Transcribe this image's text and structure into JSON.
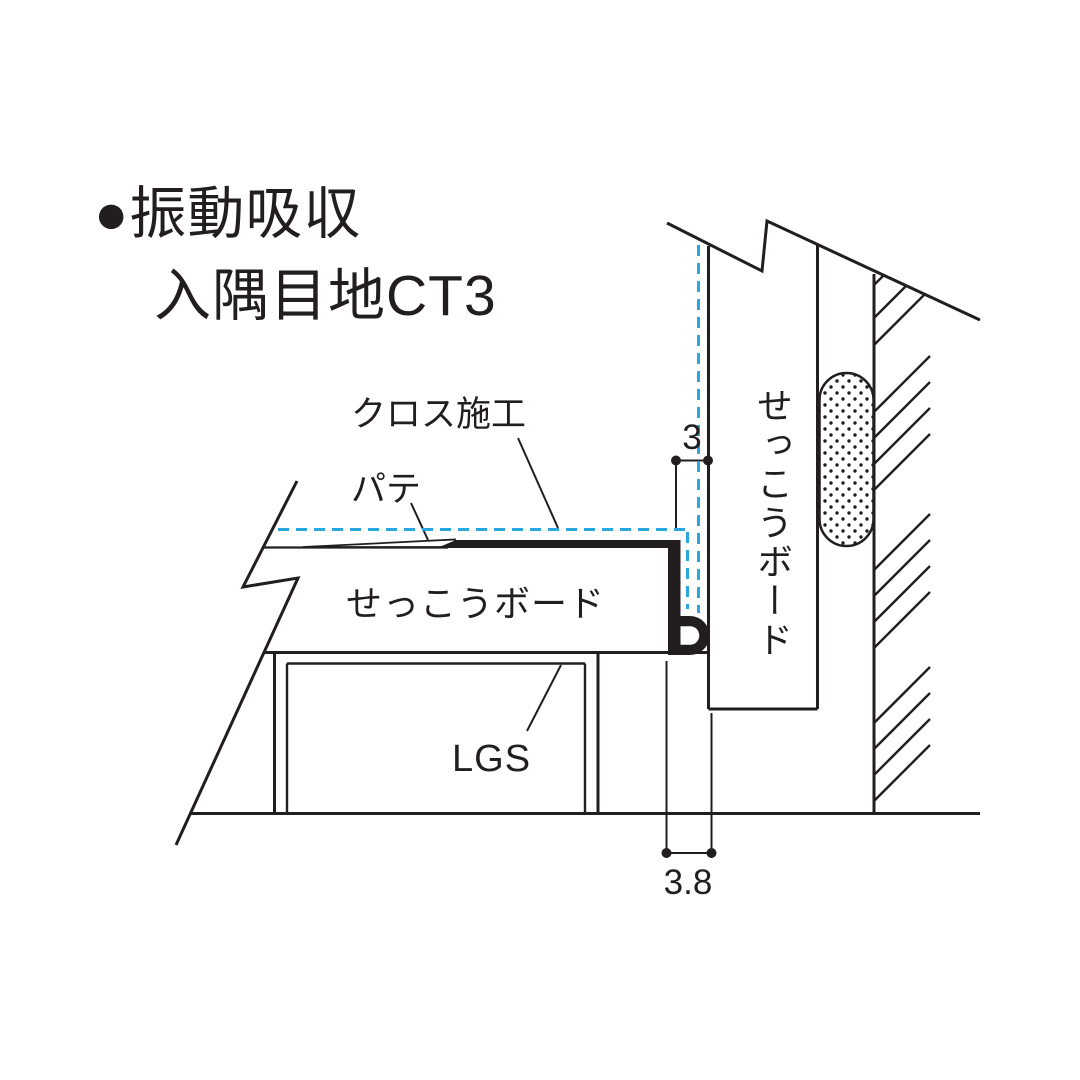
{
  "title": {
    "line1": "●振動吸収",
    "line2": "入隅目地CT3"
  },
  "labels": {
    "cross_finish": "クロス施工",
    "putty": "パテ",
    "gypsum_board_ceiling": "せっこうボード",
    "lgs": "LGS",
    "gypsum_board_wall": "せっこうボード"
  },
  "dimensions": {
    "joint_gap_top": "3",
    "joint_gap_bottom": "3.8"
  },
  "colors": {
    "line": "#221e1f",
    "accent_dashed": "#2ba6de",
    "background": "#ffffff"
  }
}
